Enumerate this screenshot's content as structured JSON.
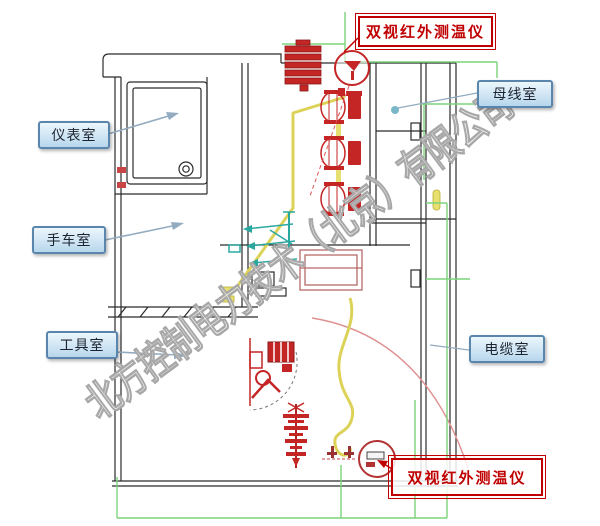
{
  "watermark": {
    "text": "北方控制电力技术（北京）有限公司"
  },
  "callouts": {
    "instrument_room": {
      "label": "仪表室"
    },
    "handcart_room": {
      "label": "手车室"
    },
    "tool_room": {
      "label": "工具室"
    },
    "busbar_room": {
      "label": "母线室"
    },
    "cable_room": {
      "label": "电缆室"
    }
  },
  "sensor_labels": {
    "top": {
      "label": "双视红外测温仪"
    },
    "bottom": {
      "label": "双视红外测温仪"
    }
  },
  "colors": {
    "callout_border": "#5a86ad",
    "callout_fill": "#cfe5f4",
    "sensor_red": "#c00000",
    "line_black": "#2b2b2b",
    "busbar_yellow": "#dcd258",
    "wiring_green": "#7cd47c",
    "arrow_teal": "#2aa8a0",
    "leader_slate": "#93abc0",
    "watermark_gray": "#a8a8a8"
  }
}
